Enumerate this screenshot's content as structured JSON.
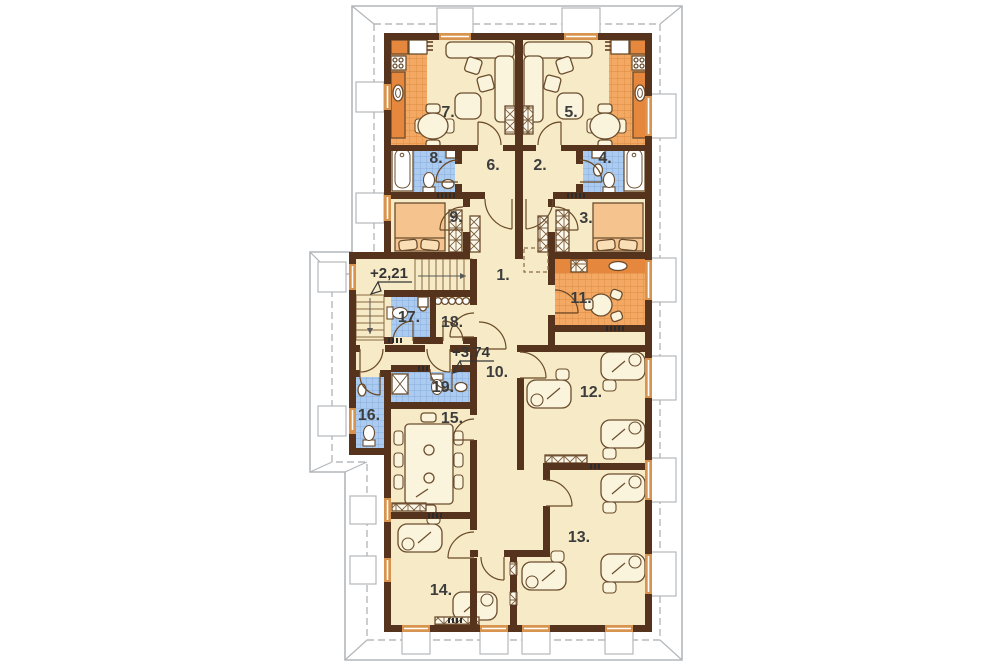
{
  "floor_plan": {
    "rooms": [
      {
        "id": 1,
        "label": "1."
      },
      {
        "id": 2,
        "label": "2."
      },
      {
        "id": 3,
        "label": "3."
      },
      {
        "id": 4,
        "label": "4."
      },
      {
        "id": 5,
        "label": "5."
      },
      {
        "id": 6,
        "label": "6."
      },
      {
        "id": 7,
        "label": "7."
      },
      {
        "id": 8,
        "label": "8."
      },
      {
        "id": 9,
        "label": "9."
      },
      {
        "id": 10,
        "label": "10."
      },
      {
        "id": 11,
        "label": "11."
      },
      {
        "id": 12,
        "label": "12."
      },
      {
        "id": 13,
        "label": "13."
      },
      {
        "id": 14,
        "label": "14."
      },
      {
        "id": 15,
        "label": "15."
      },
      {
        "id": 16,
        "label": "16."
      },
      {
        "id": 17,
        "label": "17."
      },
      {
        "id": 18,
        "label": "18."
      },
      {
        "id": 19,
        "label": "19."
      }
    ],
    "level_markers": [
      {
        "label": "+2,21"
      },
      {
        "label": "+3,74"
      }
    ],
    "colors": {
      "wall": "#553category"
    }
  },
  "colors": {
    "wall": "#55331d",
    "floor": "#f6ebc6",
    "tile_orange": "#f3a963",
    "tile_orange_dark": "#e5873c",
    "tile_blue": "#abcbf0",
    "bed": "#f5c48e",
    "furniture": "#fbf4dd",
    "roof_line": "#b3b7ba",
    "label_text": "#3d3d3d"
  }
}
